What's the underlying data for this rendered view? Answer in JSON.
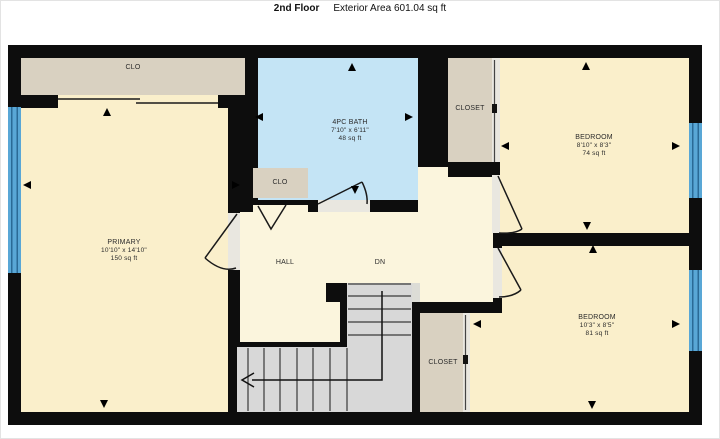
{
  "header": {
    "title": "2nd Floor",
    "subtitle": "Exterior Area 601.04 sq ft"
  },
  "rooms": {
    "closet_top_left": {
      "label": "CLO"
    },
    "primary": {
      "name": "PRIMARY",
      "dims": "10'10\" x 14'10\"",
      "area": "150 sq ft"
    },
    "bath": {
      "name": "4PC BATH",
      "dims": "7'10\" x 6'11\"",
      "area": "48 sq ft"
    },
    "closet_hall": {
      "label": "CLO"
    },
    "closet_upper": {
      "label": "CLOSET"
    },
    "bedroom_upper": {
      "name": "BEDROOM",
      "dims": "8'10\" x 8'3\"",
      "area": "74 sq ft"
    },
    "hall": {
      "label": "HALL"
    },
    "stairs": {
      "label": "DN"
    },
    "closet_lower": {
      "label": "CLOSET"
    },
    "bedroom_lower": {
      "name": "BEDROOM",
      "dims": "10'3\" x 8'5\"",
      "area": "81 sq ft"
    }
  },
  "colors": {
    "wall": "#0d0d0d",
    "room_fill": "#faefcb",
    "hall_fill": "#fbf5dd",
    "closet_fill": "#d9d1c1",
    "bath_fill": "#c4e4f5",
    "window_blue": "#59a7d6",
    "stairs_gray": "#d8d8d8"
  }
}
